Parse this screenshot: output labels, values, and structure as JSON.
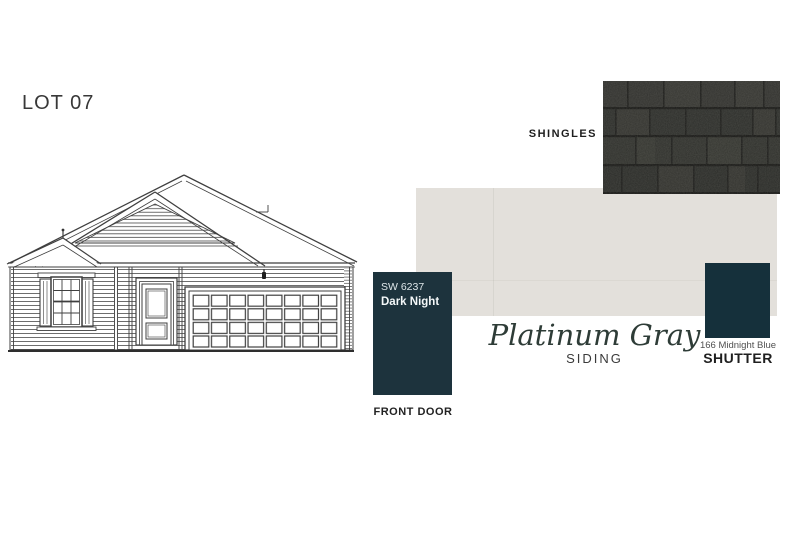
{
  "palette": {
    "page_background": "#ffffff",
    "siding_swatch": "#e3e0db",
    "shingles_swatch": "#2d2d2b",
    "front_door_swatch": "#1d333d",
    "shutter_swatch": "#15303b",
    "siding_name_text": "#2e3c37",
    "drawing_line": "#3f3f3f"
  },
  "lot": {
    "label": "LOT 07"
  },
  "shingles": {
    "label": "SHINGLES"
  },
  "siding": {
    "name": "Platinum Gray",
    "label": "SIDING"
  },
  "front_door": {
    "code": "SW 6237",
    "name": "Dark Night",
    "label": "FRONT DOOR"
  },
  "shutter": {
    "code": "166 Midnight Blue",
    "label": "SHUTTER"
  }
}
